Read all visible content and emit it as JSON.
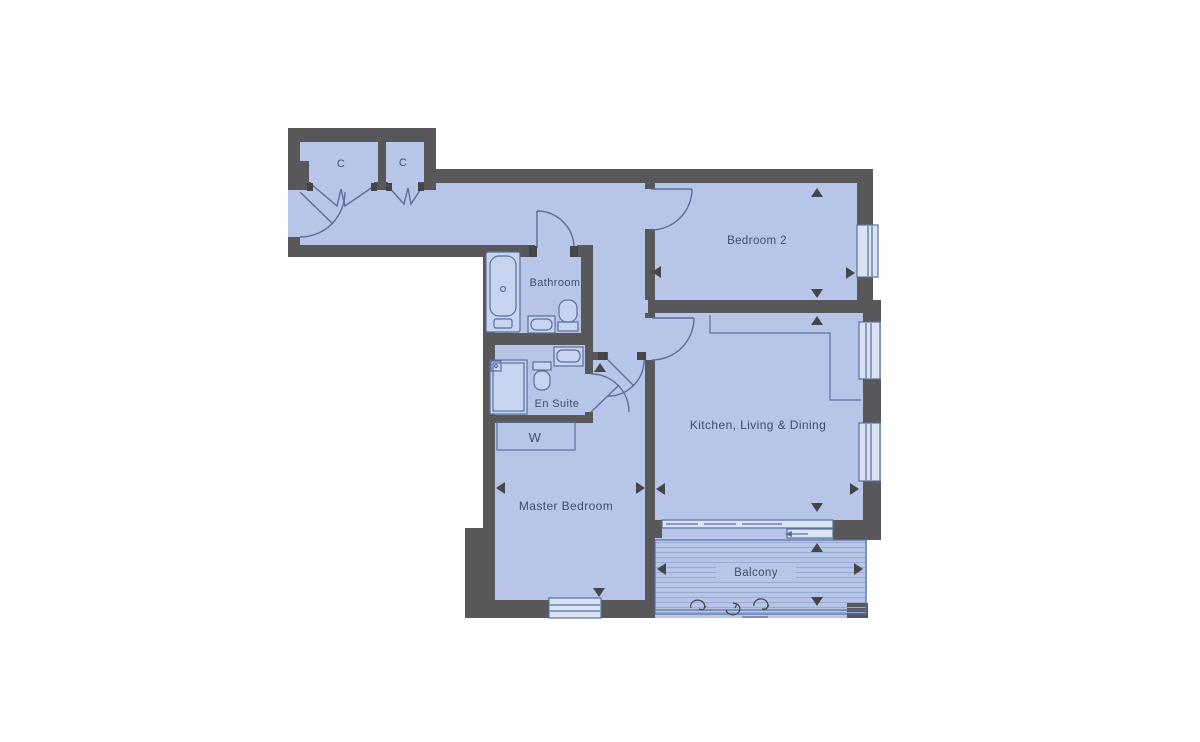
{
  "rooms": {
    "closet_1": {
      "label": "C"
    },
    "closet_2": {
      "label": "C"
    },
    "bathroom": {
      "label": "Bathroom"
    },
    "bedroom_2": {
      "label": "Bedroom 2"
    },
    "en_suite": {
      "label": "En Suite"
    },
    "wardrobe": {
      "label": "W"
    },
    "kitchen_living_dining": {
      "label": "Kitchen, Living & Dining"
    },
    "master_bedroom": {
      "label": "Master Bedroom"
    },
    "balcony": {
      "label": "Balcony"
    }
  },
  "fixtures": [
    "bathtub",
    "basin",
    "toilet",
    "shower",
    "wardrobe",
    "kitchen-counter",
    "sliding-door",
    "window",
    "balcony-decking"
  ],
  "colors": {
    "background": "#ffffff",
    "floor": "#b7c6e8",
    "wall": "#58585a",
    "line": "#5a6f9e",
    "text": "#3d4f6b",
    "stripe": "#97abd4",
    "window": "#d9e3f4",
    "fixture": "#c7d4ef",
    "marker": "#45454a"
  }
}
